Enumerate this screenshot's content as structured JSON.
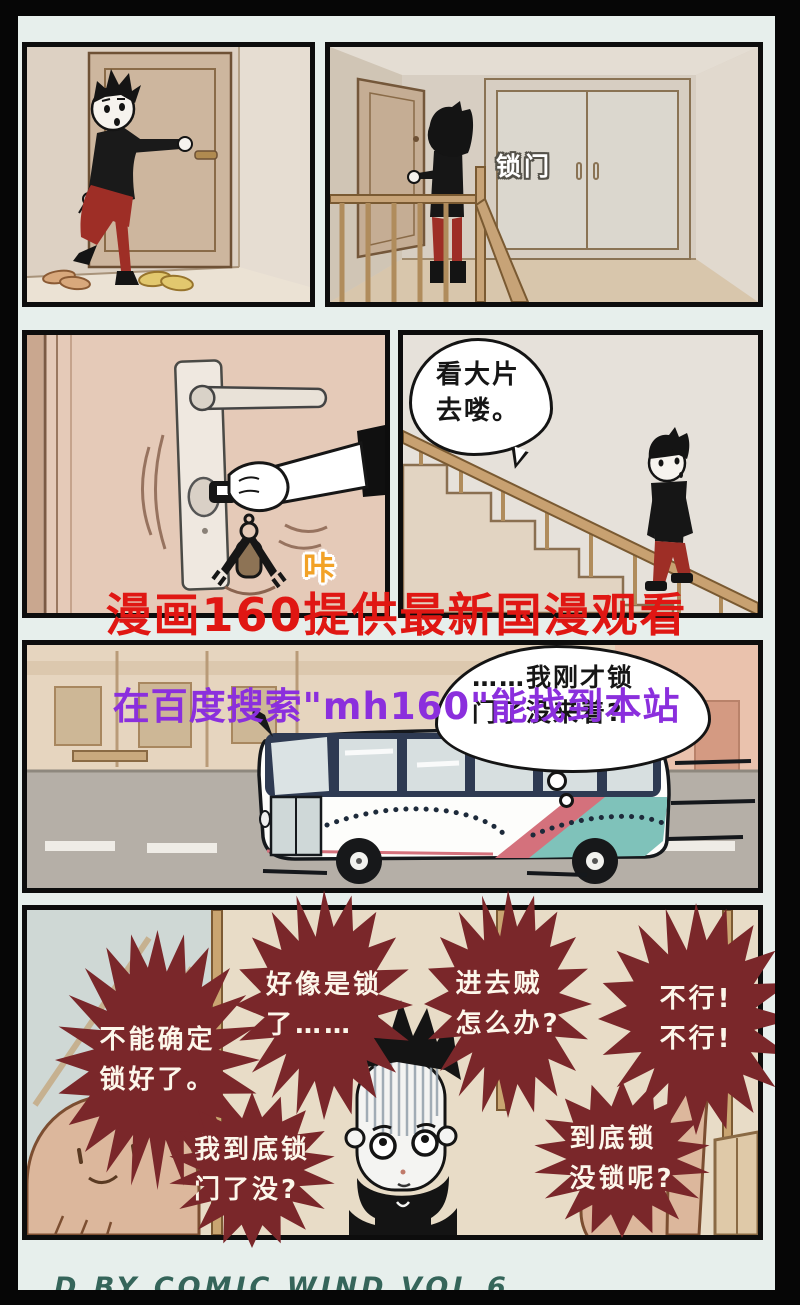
{
  "comic": {
    "panel2_door_label": "锁门",
    "panel3_sfx": "咔",
    "panel4_speech": {
      "l1": "看大片",
      "l2": "去喽。"
    },
    "panel5_thought": {
      "l1": "……我刚才锁",
      "l2": "门了没来着?"
    }
  },
  "watermarks": {
    "red": "漫画160提供最新国漫观看",
    "blue": "在百度搜索\"mh160\"能找到本站"
  },
  "bubbles": [
    {
      "l1": "不能确定",
      "l2": "锁好了。"
    },
    {
      "l1": "好像是锁",
      "l2": "了……"
    },
    {
      "l1": "进去贼",
      "l2": "怎么办?"
    },
    {
      "l1": "不行!",
      "l2": "不行!"
    },
    {
      "l1": "我到底锁",
      "l2": "门了没?"
    },
    {
      "l1": "到底锁",
      "l2": "没锁呢?"
    }
  ],
  "footer": {
    "clipped_text": "D BY COMIC WIND VOL 6"
  },
  "colors": {
    "bubble_maroon": "#7a272a",
    "watermark_red": "#e01713",
    "watermark_purple": "#8b2fdd",
    "pants_red": "#9e2e26",
    "bus_teal": "#7fc2ba",
    "bus_stripe": "#d4717c"
  }
}
